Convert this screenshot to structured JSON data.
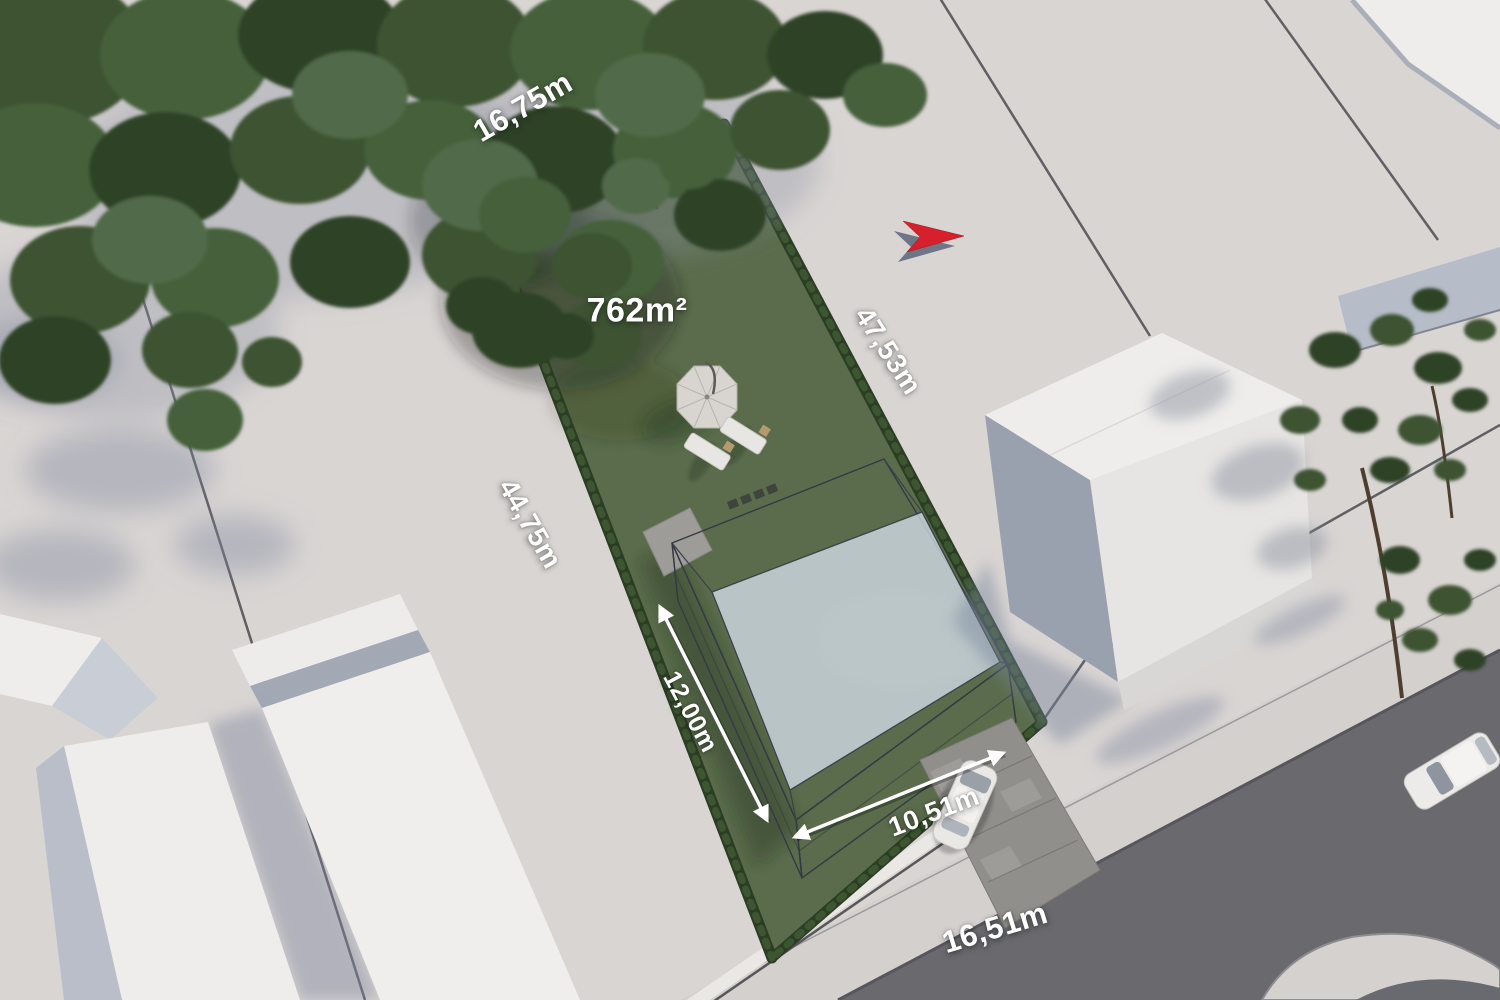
{
  "plot": {
    "area_label": "762m²",
    "dimensions": {
      "top_width": "16,75m",
      "side_right": "47,53m",
      "side_left": "44,75m",
      "street_front": "16,51m"
    }
  },
  "house": {
    "depth_label": "12,00m",
    "width_label": "10,51m"
  },
  "compass": {
    "icon": "north-arrow-icon"
  },
  "colors": {
    "ground": "#d9d5d3",
    "road": "#69696e",
    "sidewalk": "#d4d0ce",
    "driveway": "#918f8b",
    "grass": "#5a6c4b",
    "hedge": "#2b3e24",
    "glass_top": "#c3d0e2",
    "glass_side": "#9fb2cb",
    "building_white": "#efedeb",
    "north_arrow_red": "#d6212d",
    "label_text": "#ffffff"
  }
}
